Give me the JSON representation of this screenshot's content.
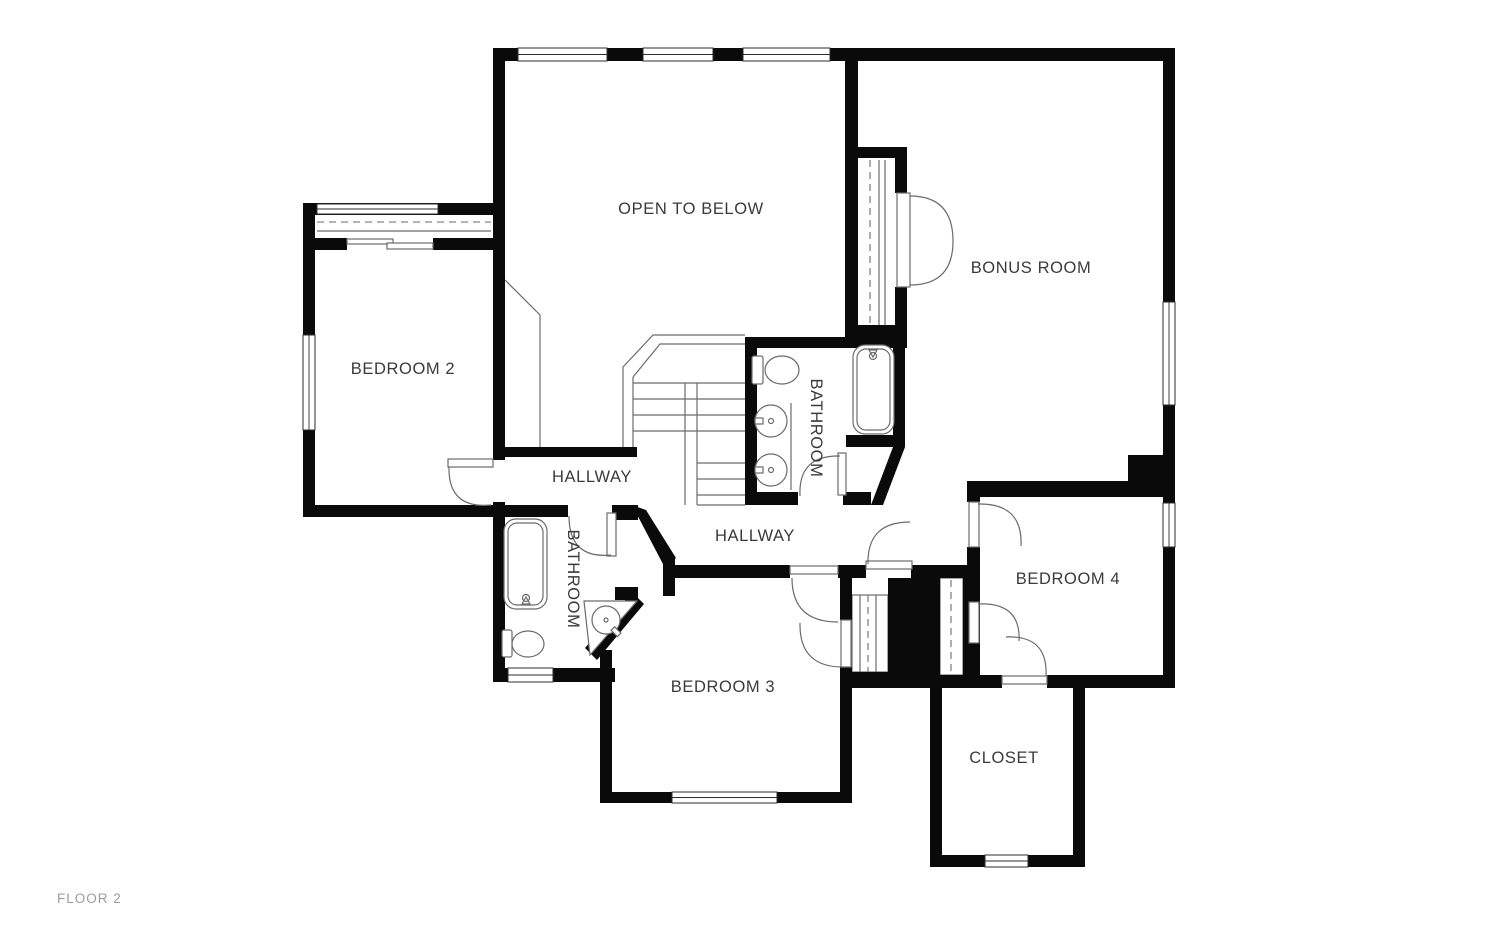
{
  "title": "FLOOR 2",
  "floor_label": "FLOOR 2",
  "colors": {
    "background": "#ffffff",
    "wall": "#0a0a0a",
    "fixture_line": "#6b6b6b",
    "label": "#3a3a3a",
    "floor_label": "#9c9c9c"
  },
  "rooms": [
    {
      "id": "open-to-below",
      "label": "OPEN TO BELOW"
    },
    {
      "id": "bonus-room",
      "label": "BONUS ROOM"
    },
    {
      "id": "bedroom-2",
      "label": "BEDROOM 2"
    },
    {
      "id": "bathroom-main",
      "label": "BATHROOM"
    },
    {
      "id": "hallway-upper",
      "label": "HALLWAY"
    },
    {
      "id": "hallway-lower",
      "label": "HALLWAY"
    },
    {
      "id": "bathroom-hall",
      "label": "BATHROOM"
    },
    {
      "id": "bedroom-3",
      "label": "BEDROOM 3"
    },
    {
      "id": "bedroom-4",
      "label": "BEDROOM 4"
    },
    {
      "id": "closet",
      "label": "CLOSET"
    }
  ]
}
